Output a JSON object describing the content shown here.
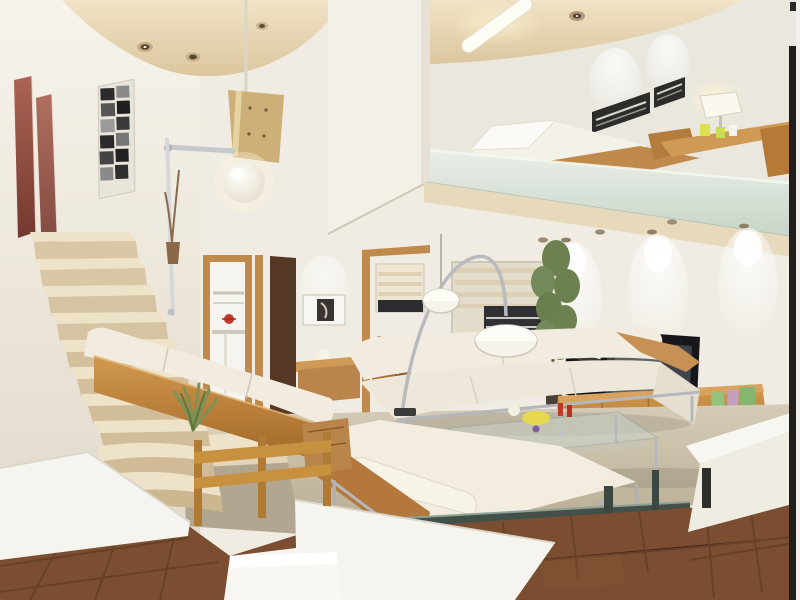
{
  "scene": {
    "type": "interior-3d-render",
    "description": "Modern loft apartment 3D rendering: high stairwell with cream staircase and globe pendant at left, mezzanine bedroom above the living room at right, white leather sofa set with wood backs around a glass coffee table, arc lamp, TV on a wooden media cabinet against the spot-lit right wall, terracotta tile floor in the sunken foreground",
    "rooms": [
      "stairwell",
      "hallway",
      "kitchen",
      "living-room",
      "mezzanine-bedroom"
    ]
  },
  "palette": {
    "wall": "#f0ece3",
    "wall_shade": "#e3dccd",
    "ceiling": "#ecd9b6",
    "slab": "#dbe4da",
    "stair_tread": "#eee2c8",
    "stair_riser": "#d8c6a5",
    "wood": "#c08a4c",
    "wood_dark": "#a86e30",
    "door_dark": "#553823",
    "sofa_white": "#f1ecdf",
    "sofa_shade": "#e2dac9",
    "chrome": "#b4b8bc",
    "carpet": "#c9bfa8",
    "tile": "#7b4e31",
    "grout": "#55341f",
    "tv_black": "#17171b",
    "screen": "#3f444a",
    "art_red": "#9e5a4c",
    "art_dark": "#2e2c2a",
    "plant": "#6d8150",
    "book_green": "#93c27c",
    "book_pink": "#c3a0c0",
    "book_green2": "#86b56d",
    "balustrade": "#43504a",
    "white_block": "#f6f4ee",
    "glow": "#fff3d2",
    "floor_gray": "#b3a691",
    "railing_wood": "#c8913f"
  },
  "objects": [
    {
      "name": "staircase",
      "color": "stair_tread"
    },
    {
      "name": "globe-pendant-lamp",
      "color": "glow"
    },
    {
      "name": "red-wall-art-panels",
      "color": "art_red"
    },
    {
      "name": "bw-photo-collage",
      "color": "art_dark"
    },
    {
      "name": "mezzanine-slab",
      "color": "slab"
    },
    {
      "name": "mezzanine-bed",
      "color": "sofa_white"
    },
    {
      "name": "mezzanine-desk",
      "color": "wood"
    },
    {
      "name": "desk-lamp",
      "color": "glow"
    },
    {
      "name": "panoramic-bw-artwork",
      "color": "art_dark"
    },
    {
      "name": "window-blinds",
      "color": "stair_tread"
    },
    {
      "name": "arc-floor-lamp",
      "color": "chrome"
    },
    {
      "name": "dome-pendant-lamp",
      "color": "sofa_white"
    },
    {
      "name": "two-seat-sofa",
      "color": "sofa_white"
    },
    {
      "name": "chaise-sofa",
      "color": "sofa_white"
    },
    {
      "name": "glass-coffee-table",
      "color": "chrome"
    },
    {
      "name": "flat-screen-tv",
      "color": "tv_black"
    },
    {
      "name": "media-cabinet",
      "color": "wood"
    },
    {
      "name": "speaker-unit",
      "color": "tv_black"
    },
    {
      "name": "books",
      "color": "book_green"
    },
    {
      "name": "potted-plant",
      "color": "plant"
    },
    {
      "name": "wooden-railing",
      "color": "railing_wood"
    },
    {
      "name": "hallway-doors",
      "color": "wood"
    },
    {
      "name": "kitchen-doorway",
      "color": "wall"
    },
    {
      "name": "wall-niche-art",
      "color": "art_dark"
    },
    {
      "name": "console-table",
      "color": "wood"
    },
    {
      "name": "dining-chairs",
      "color": "wood_dark"
    },
    {
      "name": "glass-balustrade",
      "color": "balustrade"
    },
    {
      "name": "white-half-wall",
      "color": "white_block"
    },
    {
      "name": "tile-floor",
      "color": "tile"
    },
    {
      "name": "sofa-platform",
      "color": "white_block"
    }
  ]
}
